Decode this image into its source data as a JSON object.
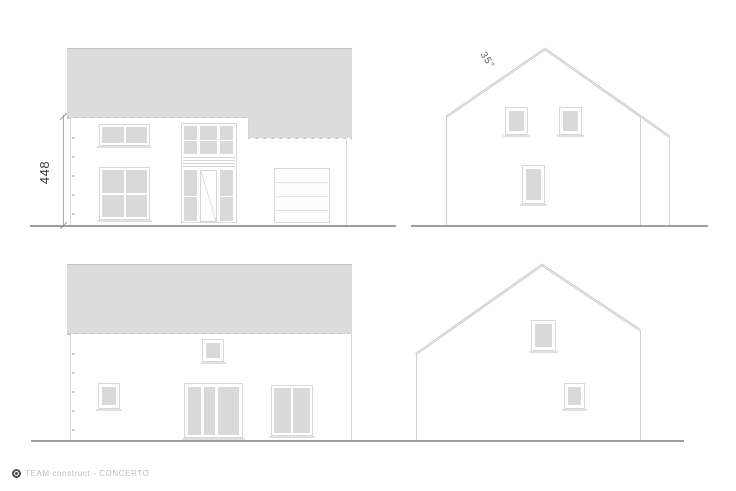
{
  "annotations": {
    "height_dimension": "448",
    "roof_angle": "35°"
  },
  "footer": {
    "brand": "TEAM construct - CONCERTO",
    "logo_icon": "teamconstruct-logo"
  },
  "colors": {
    "roof_fill": "#dcdcdc",
    "glass_fill": "#d9d9d9",
    "outline": "#d5d5d5",
    "ground_line": "#9e9e9e",
    "dimension_text": "#3d3d3d",
    "footer_text": "#bdbdbd"
  },
  "elevations": [
    {
      "id": "front"
    },
    {
      "id": "side-right"
    },
    {
      "id": "rear"
    },
    {
      "id": "side-left"
    }
  ]
}
